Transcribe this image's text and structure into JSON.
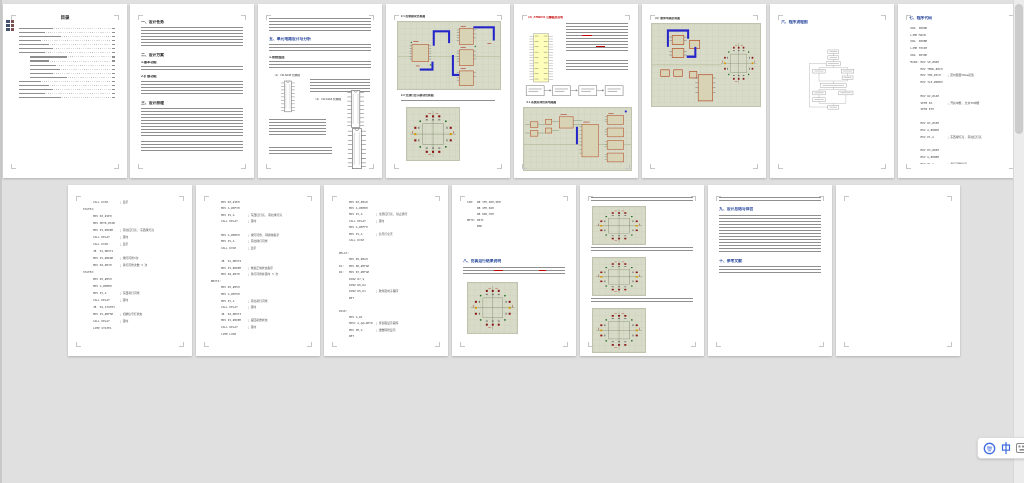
{
  "window": {
    "background_color": "#e0e0e0",
    "page_color": "#ffffff",
    "heading_accent_color": "#24459c",
    "schematic_background_color": "#d7dbc7",
    "schematic_wire_color": "#2524c9",
    "view": "multi-page zoomed-out document view",
    "page_count_visible": 15
  },
  "ime": {
    "logo_icon": "pinyin-logo",
    "mode_cn": "中"
  },
  "pages": {
    "p1": {
      "title": "目录",
      "toc_rows": 18
    },
    "p2": {
      "h1": "一、设计任务",
      "h2": "二、设计方案",
      "s1": "1.基本功能",
      "s2": "2.扩展功能",
      "h3": "三、设计原理"
    },
    "p3": {
      "h": "五、单元电路设计与分析",
      "s1": "1.系统组成",
      "cap1": "（1）74LS245 管脚图",
      "cap2": "（2）74LS164 管脚图"
    },
    "p4": {
      "cap1": "2.1 控制模块仿真图",
      "cap2": "2.2 交通灯显示模块仿真图"
    },
    "p5": {
      "cap1": "（3）AT89C51 引脚图及说明",
      "cap2": "3.1 系统总体仿真电路图"
    },
    "p6": {
      "cap": "（4）整体电路仿真图"
    },
    "p7": {
      "h": "六、程序流程图"
    },
    "p8": {
      "h": "七、程序代码",
      "code": [
        "ORG  0000H",
        "LJMP MAIN",
        "ORG  000BH",
        "LJMP T0INT",
        "ORG  0030H",
        "MAIN: MOV SP,#60H",
        "      MOV TMOD,#01H",
        "      MOV TH0,#3CH    ；定时器置50ms初值",
        "      MOV TL0,#0B0H",
        "",
        "      MOV R2,#14H",
        "      SETB EA         ；开总中断, 允许T0中断",
        "      SETB ET0",
        "",
        "      MOV R3,#1EH",
        "      MOV A,#0DDH",
        "      MOV P1,A        ；东西绿灯亮, 南北红灯亮",
        "",
        "      MOV R3,#05H",
        "      MOV A,#0DBH",
        "      MOV P1,A        ；黄灯闪烁提示"
      ]
    },
    "p9": {
      "code": [
        "      CALL DISP       ；显示",
        "STATE1:",
        "      MOV R3,#1EH",
        "      MOV DPTR,#TAB",
        "      MOV P1,#0DEH    ；南北红灯亮, 东西绿灯亮",
        "      CALL DELAY      ；延时",
        "      CALL DISP       ；显示",
        "      JB  K1,NEXT1",
        "      MOV P1,#0DDH    ；绿灯闪烁3次",
        "      MOV R4,#03H     ；黄灯闪烁次数 3 次",
        "STATE2:",
        "      MOV R3,#05H",
        "      MOV A,#0EBH",
        "      MOV P1,A        ；东西黄灯闪烁",
        "      CALL DELAY      ；延时",
        "      JB  K2,STATE3",
        "      MOV P1,#0F5H    ；切换信号灯状态",
        "      CALL DELAY      ；延时",
        "      LJMP STATE1"
      ]
    },
    "p10": {
      "code": [
        "      MOV R3,#1EH",
        "      MOV A,#0F3H",
        "      MOV P1,A        ；东西红灯亮, 南北绿灯亮",
        "      CALL DELAY      ；延时",
        "",
        "      MOV A,#0EDH     ；绿灯闪烁, 转换前提示",
        "      MOV P1,A        ；南北绿灯闪烁",
        "      CALL DISP       ；显示",
        "",
        "      JB  K1,NEXT2",
        "      MOV P1,#0DEH    ；恢复正常状态指示",
        "      MOV R4,#03H     ；黄灯闪烁并延时 3 次",
        "NEXT2:",
        "      MOV R3,#05H",
        "      MOV A,#0F6H",
        "      MOV P1,A        ；南北黄灯闪烁",
        "      CALL DELAY      ；延时",
        "      JB  K2,NEXT3",
        "      MOV P1,#0DEH    ；返回初始状态",
        "      CALL DELAY      ；延时",
        "      LJMP LOOP"
      ]
    },
    "p11": {
      "code": [
        "      MOV R3,#0AH",
        "      MOV A,#0EBH",
        "      MOV P1,A        ；全部红灯亮, 禁止通行",
        "      CALL DELAY      ；延时",
        "      MOV A,#0FFH",
        "      MOV P1,A        ；信号灯全灭",
        "      CALL DISP",
        "",
        "DELAY:",
        "      MOV R5,#0AH",
        "D1:   MOV R6,#0FAH",
        "D2:   MOV R7,#0FAH",
        "      DJNZ R7,$",
        "      DJNZ R6,D2",
        "      DJNZ R5,D1      ；软件延时子程序",
        "      RET",
        "",
        "DISP:",
        "      MOV A,R1",
        "      MOVC A,@A+DPTR  ；查表取显示段码",
        "      MOV P0,A        ；送数码管显示",
        "      RET"
      ]
    },
    "p12": {
      "code": [
        "TAB:  DB 3FH,06H,5BH",
        "      DB 4FH,66H",
        "      DB 6DH,7DH",
        "RET0: RETI",
        "      END"
      ],
      "h": "八、仿真运行结果说明"
    },
    "p14": {
      "h1": "九、设计总结与体会",
      "h2": "十、参考文献"
    }
  }
}
